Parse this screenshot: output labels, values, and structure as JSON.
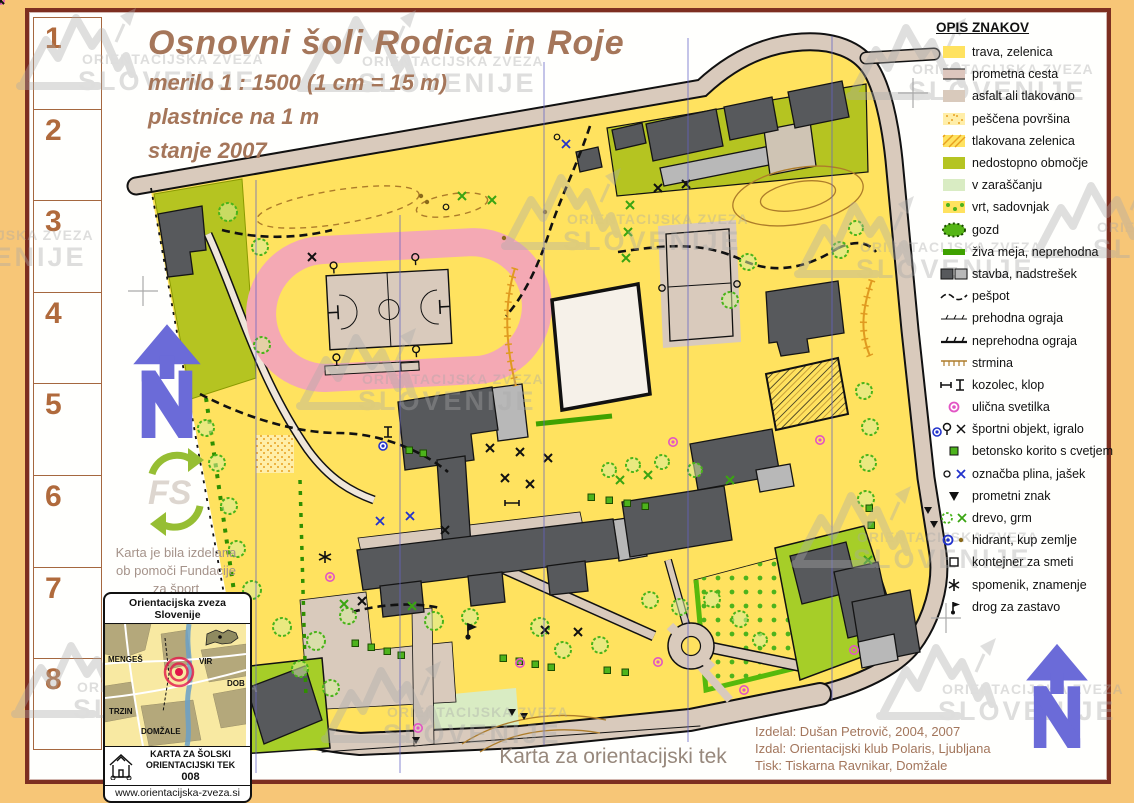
{
  "title": {
    "main": "Osnovni šoli Rodica in Roje",
    "scale": "merilo 1 : 1500 (1 cm = 15 m)",
    "contours": "plastnice na 1 m",
    "state": "stanje 2007"
  },
  "sidebar": {
    "cells": [
      "1",
      "2",
      "3",
      "4",
      "5",
      "6",
      "7",
      "8"
    ]
  },
  "legend": {
    "title": "OPIS ZNAKOV",
    "items": [
      {
        "icon": "grass",
        "label": "trava, zelenica"
      },
      {
        "icon": "road",
        "label": "prometna cesta"
      },
      {
        "icon": "asphalt",
        "label": "asfalt ali tlakovano"
      },
      {
        "icon": "sand",
        "label": "peščena površina"
      },
      {
        "icon": "paved-green",
        "label": "tlakovana zelenica"
      },
      {
        "icon": "forbidden",
        "label": "nedostopno območje"
      },
      {
        "icon": "overgrown",
        "label": "v zaraščanju"
      },
      {
        "icon": "garden",
        "label": "vrt, sadovnjak"
      },
      {
        "icon": "forest",
        "label": "gozd"
      },
      {
        "icon": "hedge",
        "label": "živa meja, neprehodna"
      },
      {
        "icon": "building",
        "label": "stavba, nadstrešek"
      },
      {
        "icon": "footpath",
        "label": "pešpot"
      },
      {
        "icon": "fence-passable",
        "label": "prehodna ograja"
      },
      {
        "icon": "fence-impassable",
        "label": "neprehodna ograja"
      },
      {
        "icon": "slope",
        "label": "strmina"
      },
      {
        "icon": "hayrack-bench",
        "label": "kozolec, klop"
      },
      {
        "icon": "streetlamp",
        "label": "ulična svetilka"
      },
      {
        "icon": "sport-playground",
        "label": "športni objekt, igralo"
      },
      {
        "icon": "planter",
        "label": "betonsko korito s cvetjem"
      },
      {
        "icon": "gas-mark",
        "label": "označba plina, jašek"
      },
      {
        "icon": "traffic-sign",
        "label": "prometni znak"
      },
      {
        "icon": "tree-bush",
        "label": "drevo, grm"
      },
      {
        "icon": "hydrant-mound",
        "label": "hidrant, kup zemlje"
      },
      {
        "icon": "trash",
        "label": "kontejner za smeti"
      },
      {
        "icon": "monument",
        "label": "spomenik, znamenje"
      },
      {
        "icon": "flagpole",
        "label": "drog za zastavo"
      }
    ]
  },
  "watermark": {
    "line1": "ORIENTACIJSKA ZVEZA",
    "line2": "SLOVENIJE"
  },
  "fs": {
    "caption_lines": [
      "Karta je bila izdelana",
      "ob pomoči Fundacije",
      "za šport"
    ]
  },
  "inset": {
    "header": "Orientacijska zveza Slovenije",
    "places": [
      "MENGEŠ",
      "VIR",
      "DOB",
      "TRZIN",
      "DOMŽALE"
    ],
    "footer_line1": "KARTA ZA ŠOLSKI",
    "footer_line2": "ORIENTACIJSKI TEK",
    "number": "008",
    "url": "www.orientacijska-zveza.si"
  },
  "footer": {
    "caption": "Karta za orientacijski tek"
  },
  "credits": {
    "lines": [
      "Izdelal: Dušan Petrovič, 2004, 2007",
      "Izdal: Orientacijski klub Polaris, Ljubljana",
      "Tisk: Tiskarna Ravnikar, Domžale"
    ]
  },
  "palette": {
    "frame_orange": "#f7c677",
    "border_maroon": "#7d2e20",
    "open_yellow": "#ffe25f",
    "road_tan": "#d9cabc",
    "track_pink": "#f4a9b4",
    "olive_forbidden": "#b5c421",
    "lime_compound": "#a6ce28",
    "overgrown_green": "#d9ecc3",
    "building_gray": "#57595c",
    "canopy_gray": "#b8b8b8",
    "grid_blue": "#6363c4",
    "lamp_magenta": "#e255c4",
    "title_brown": "#a5765a"
  }
}
